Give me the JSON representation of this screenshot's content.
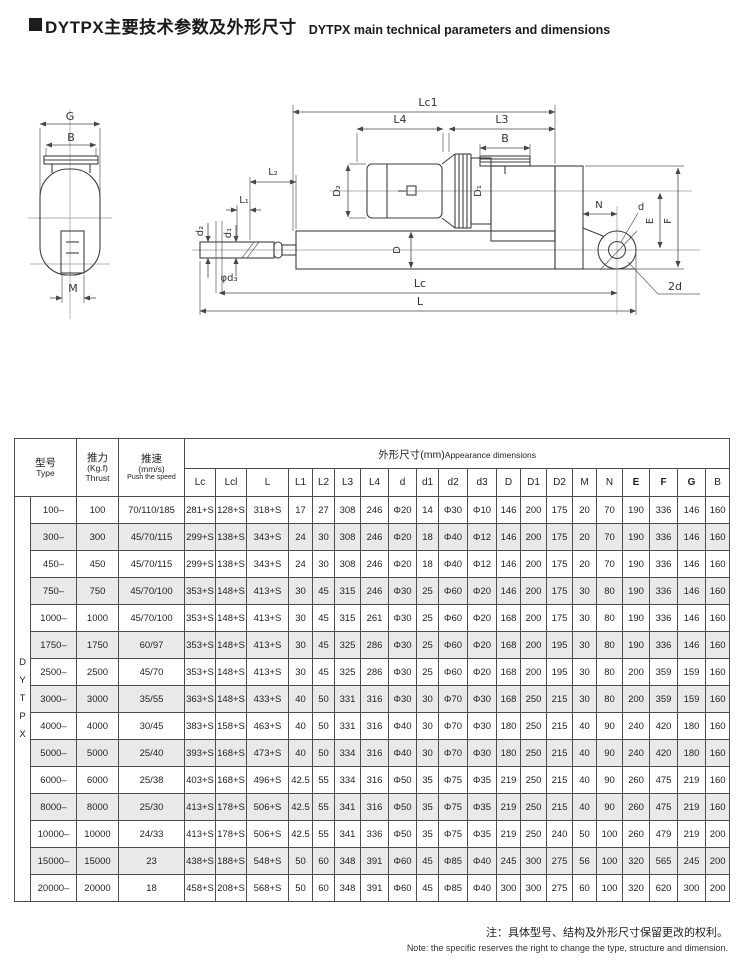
{
  "header": {
    "title_zh": "DYTPX主要技术参数及外形尺寸",
    "title_en": "DYTPX main technical parameters and dimensions"
  },
  "diagram": {
    "labels": {
      "G": "G",
      "B_left": "B",
      "M": "M",
      "Lc1": "Lc1",
      "L4": "L4",
      "L3": "L3",
      "B_top": "B",
      "L1": "L₁",
      "L2": "L₂",
      "d1": "d₁",
      "d2": "d₂",
      "d3": "φd₃",
      "D": "D",
      "D1": "D₁",
      "D2": "D₂",
      "N": "N",
      "d": "d",
      "E": "E",
      "F": "F",
      "Lc": "Lc",
      "L": "L",
      "twod": "2d"
    }
  },
  "table": {
    "group_letters": [
      "D",
      "Y",
      "T",
      "P",
      "X"
    ],
    "col_type": {
      "zh": "型号",
      "en": "Type"
    },
    "col_thrust": {
      "zh": "推力",
      "unit": "(Kg.f)",
      "en": "Thrust"
    },
    "col_speed": {
      "zh": "推速",
      "unit": "(mm/s)",
      "en": "Push the speed"
    },
    "dims_header": {
      "zh": "外形尺寸(mm)",
      "en": "Appearance  dimensions"
    },
    "dim_cols": [
      "Lc",
      "Lcl",
      "L",
      "L1",
      "L2",
      "L3",
      "L4",
      "d",
      "d1",
      "d2",
      "d3",
      "D",
      "D1",
      "D2",
      "M",
      "N",
      "E",
      "F",
      "G",
      "B"
    ],
    "bold_cols": [
      "E",
      "F",
      "G"
    ],
    "rows": [
      {
        "type": "100–",
        "thrust": "100",
        "speed": "70/110/185",
        "dims": [
          "281+S",
          "128+S",
          "318+S",
          "17",
          "27",
          "308",
          "246",
          "Φ20",
          "14",
          "Φ30",
          "Φ10",
          "146",
          "200",
          "175",
          "20",
          "70",
          "190",
          "336",
          "146",
          "160"
        ]
      },
      {
        "type": "300–",
        "thrust": "300",
        "speed": "45/70/115",
        "dims": [
          "299+S",
          "138+S",
          "343+S",
          "24",
          "30",
          "308",
          "246",
          "Φ20",
          "18",
          "Φ40",
          "Φ12",
          "146",
          "200",
          "175",
          "20",
          "70",
          "190",
          "336",
          "146",
          "160"
        ]
      },
      {
        "type": "450–",
        "thrust": "450",
        "speed": "45/70/115",
        "dims": [
          "299+S",
          "138+S",
          "343+S",
          "24",
          "30",
          "308",
          "246",
          "Φ20",
          "18",
          "Φ40",
          "Φ12",
          "146",
          "200",
          "175",
          "20",
          "70",
          "190",
          "336",
          "146",
          "160"
        ]
      },
      {
        "type": "750–",
        "thrust": "750",
        "speed": "45/70/100",
        "dims": [
          "353+S",
          "148+S",
          "413+S",
          "30",
          "45",
          "315",
          "246",
          "Φ30",
          "25",
          "Φ60",
          "Φ20",
          "146",
          "200",
          "175",
          "30",
          "80",
          "190",
          "336",
          "146",
          "160"
        ]
      },
      {
        "type": "1000–",
        "thrust": "1000",
        "speed": "45/70/100",
        "dims": [
          "353+S",
          "148+S",
          "413+S",
          "30",
          "45",
          "315",
          "261",
          "Φ30",
          "25",
          "Φ60",
          "Φ20",
          "168",
          "200",
          "175",
          "30",
          "80",
          "190",
          "336",
          "146",
          "160"
        ]
      },
      {
        "type": "1750–",
        "thrust": "1750",
        "speed": "60/97",
        "dims": [
          "353+S",
          "148+S",
          "413+S",
          "30",
          "45",
          "325",
          "286",
          "Φ30",
          "25",
          "Φ60",
          "Φ20",
          "168",
          "200",
          "195",
          "30",
          "80",
          "190",
          "336",
          "146",
          "160"
        ]
      },
      {
        "type": "2500–",
        "thrust": "2500",
        "speed": "45/70",
        "dims": [
          "353+S",
          "148+S",
          "413+S",
          "30",
          "45",
          "325",
          "286",
          "Φ30",
          "25",
          "Φ60",
          "Φ20",
          "168",
          "200",
          "195",
          "30",
          "80",
          "200",
          "359",
          "159",
          "160"
        ]
      },
      {
        "type": "3000–",
        "thrust": "3000",
        "speed": "35/55",
        "dims": [
          "363+S",
          "148+S",
          "433+S",
          "40",
          "50",
          "331",
          "316",
          "Φ30",
          "30",
          "Φ70",
          "Φ30",
          "168",
          "250",
          "215",
          "30",
          "80",
          "200",
          "359",
          "159",
          "160"
        ]
      },
      {
        "type": "4000–",
        "thrust": "4000",
        "speed": "30/45",
        "dims": [
          "383+S",
          "158+S",
          "463+S",
          "40",
          "50",
          "331",
          "316",
          "Φ40",
          "30",
          "Φ70",
          "Φ30",
          "180",
          "250",
          "215",
          "40",
          "90",
          "240",
          "420",
          "180",
          "160"
        ]
      },
      {
        "type": "5000–",
        "thrust": "5000",
        "speed": "25/40",
        "dims": [
          "393+S",
          "168+S",
          "473+S",
          "40",
          "50",
          "334",
          "316",
          "Φ40",
          "30",
          "Φ70",
          "Φ30",
          "180",
          "250",
          "215",
          "40",
          "90",
          "240",
          "420",
          "180",
          "160"
        ]
      },
      {
        "type": "6000–",
        "thrust": "6000",
        "speed": "25/38",
        "dims": [
          "403+S",
          "168+S",
          "496+S",
          "42.5",
          "55",
          "334",
          "316",
          "Φ50",
          "35",
          "Φ75",
          "Φ35",
          "219",
          "250",
          "215",
          "40",
          "90",
          "260",
          "475",
          "219",
          "160"
        ]
      },
      {
        "type": "8000–",
        "thrust": "8000",
        "speed": "25/30",
        "dims": [
          "413+S",
          "178+S",
          "506+S",
          "42.5",
          "55",
          "341",
          "316",
          "Φ50",
          "35",
          "Φ75",
          "Φ35",
          "219",
          "250",
          "215",
          "40",
          "90",
          "260",
          "475",
          "219",
          "160"
        ]
      },
      {
        "type": "10000–",
        "thrust": "10000",
        "speed": "24/33",
        "dims": [
          "413+S",
          "178+S",
          "506+S",
          "42.5",
          "55",
          "341",
          "336",
          "Φ50",
          "35",
          "Φ75",
          "Φ35",
          "219",
          "250",
          "240",
          "50",
          "100",
          "260",
          "479",
          "219",
          "200"
        ]
      },
      {
        "type": "15000–",
        "thrust": "15000",
        "speed": "23",
        "dims": [
          "438+S",
          "188+S",
          "548+S",
          "50",
          "60",
          "348",
          "391",
          "Φ60",
          "45",
          "Φ85",
          "Φ40",
          "245",
          "300",
          "275",
          "56",
          "100",
          "320",
          "565",
          "245",
          "200"
        ]
      },
      {
        "type": "20000–",
        "thrust": "20000",
        "speed": "18",
        "dims": [
          "458+S",
          "208+S",
          "568+S",
          "50",
          "60",
          "348",
          "391",
          "Φ60",
          "45",
          "Φ85",
          "Φ40",
          "300",
          "300",
          "275",
          "60",
          "100",
          "320",
          "620",
          "300",
          "200"
        ]
      }
    ]
  },
  "footer": {
    "note_zh": "注：具体型号、结构及外形尺寸保留更改的权利。",
    "note_en": "Note: the specific reserves the right to change the type, structure and dimension."
  }
}
